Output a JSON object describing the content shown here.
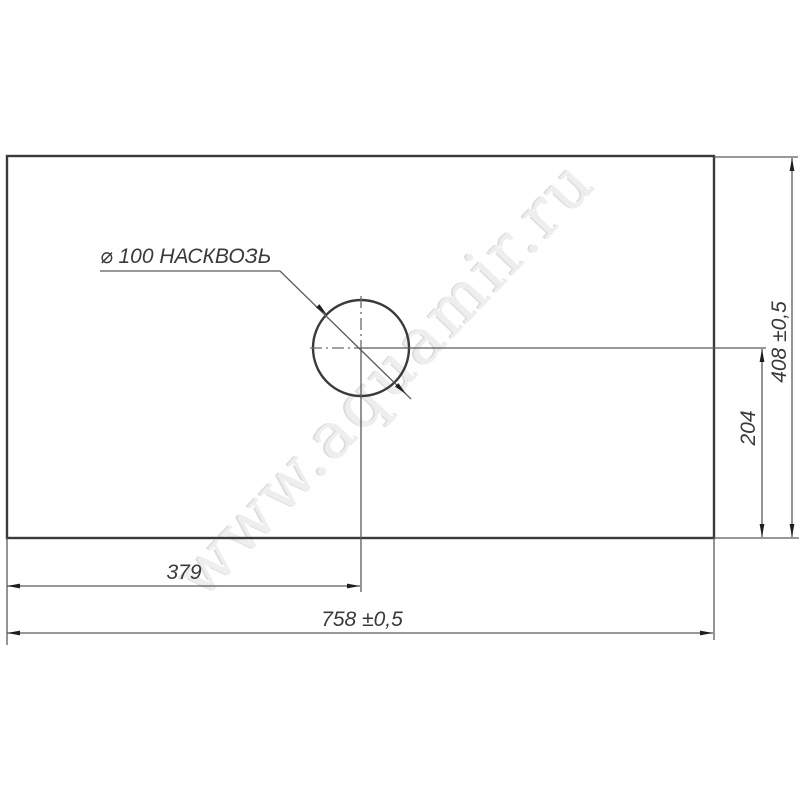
{
  "drawing": {
    "callout": "⌀ 100 НАСКВОЗЬ",
    "dims": {
      "width_total": "758 ±0,5",
      "hole_from_left": "379",
      "height_total": "408 ±0,5",
      "hole_from_bottom": "204"
    },
    "watermark": "www.aquamir.ru",
    "colors": {
      "outline": "#3a3a3a",
      "dimension_line": "#5a5a5a",
      "arrow": "#1e1e1e",
      "text": "#3a3a3a",
      "watermark": "#eeeeee",
      "background": "#ffffff"
    }
  }
}
